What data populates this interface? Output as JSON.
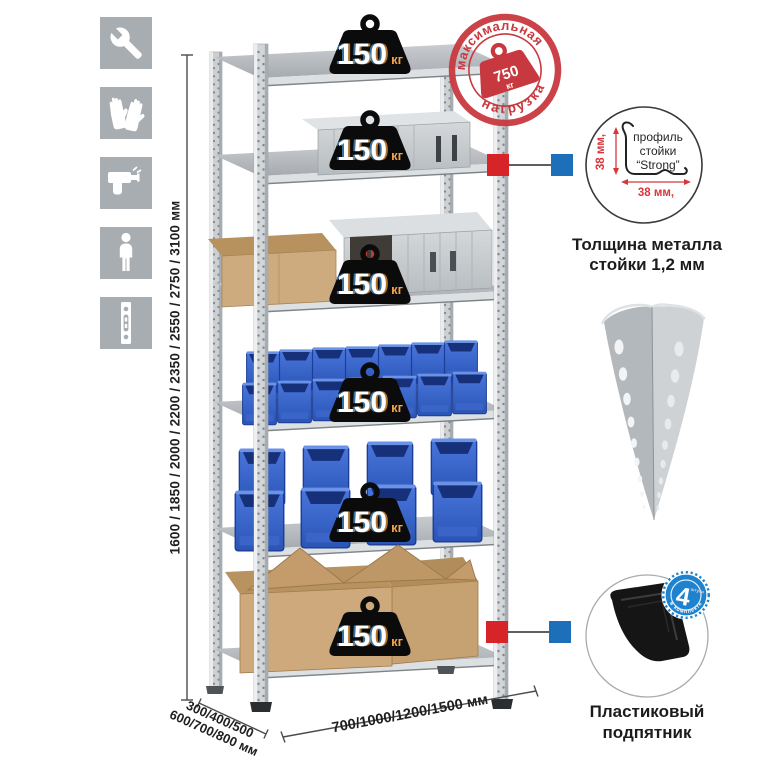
{
  "icons": [
    {
      "name": "wrench-icon"
    },
    {
      "name": "gloves-icon"
    },
    {
      "name": "drill-icon"
    },
    {
      "name": "person-icon"
    },
    {
      "name": "rack-post-icon"
    }
  ],
  "dimensions": {
    "heights": "1600 / 1850 / 2000 / 2200 / 2350 / 2550 / 2750 / 3100 мм",
    "depth_line1": "300/400/500",
    "depth_line2": "600/700/800 мм",
    "width": "700/1000/1200/1500 мм"
  },
  "shelf_badge": {
    "value": "150",
    "unit": "кг"
  },
  "stamp": {
    "arc_top": "максимальная",
    "arc_bottom": "нагрузка",
    "value": "750",
    "unit": "кг"
  },
  "profile_detail": {
    "label_line1": "профиль",
    "label_line2": "стойки",
    "label_line3": "“Strong”",
    "dim_vertical": "38 мм,",
    "dim_horizontal": "38 мм,",
    "caption_line1": "Толщина металла",
    "caption_line2": "стойки 1,2 мм"
  },
  "foot_detail": {
    "count": "4",
    "count_unit": "штуки",
    "ring_text": "в комплекте",
    "caption_line1": "Пластиковый",
    "caption_line2": "подпятник"
  },
  "colors": {
    "accent_red": "#d62429",
    "accent_blue": "#1d6fba",
    "stamp_red": "#c8393f",
    "bin_blue": "#2e5fc6",
    "icon_gray": "#a8adb1"
  }
}
